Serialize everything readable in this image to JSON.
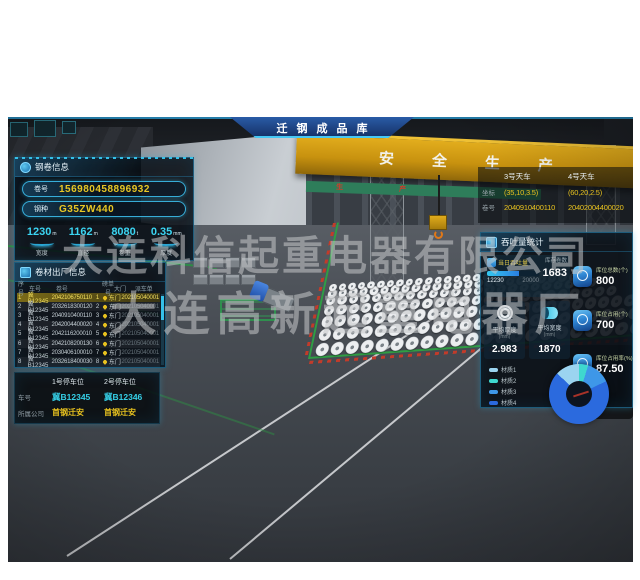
{
  "window": {
    "title": "迁钢成品库"
  },
  "scene": {
    "girder_text": "安全生产",
    "girder_text2": "生产"
  },
  "watermark": {
    "line1": "大连科信起重电器有限公司",
    "line2": "大连高新起重电器厂"
  },
  "coil_info": {
    "title": "钢卷信息",
    "fields": [
      {
        "label": "卷号",
        "value": "156980458896932"
      },
      {
        "label": "钢种",
        "value": "G35ZW440"
      }
    ],
    "stats": [
      {
        "value": "1230",
        "unit": "m",
        "label": "宽度"
      },
      {
        "value": "1162",
        "unit": "m",
        "label": "直径"
      },
      {
        "value": "8080",
        "unit": "t",
        "label": "卷重"
      },
      {
        "value": "0.35",
        "unit": "mm",
        "label": "厚度"
      }
    ]
  },
  "shipment": {
    "title": "卷材出厂信息",
    "columns": [
      "序号",
      "车号",
      "卷号",
      "磅单号",
      "大门",
      "派车单"
    ],
    "rows": [
      [
        "1",
        "冀B12345",
        "2042106750110",
        "1",
        "东门",
        "202105040001"
      ],
      [
        "2",
        "冀B12345",
        "2032618300120",
        "2",
        "东门",
        "202105040001"
      ],
      [
        "3",
        "冀B12345",
        "2040910400110",
        "3",
        "东门",
        "202105040001"
      ],
      [
        "4",
        "冀B12345",
        "2042004400020",
        "4",
        "东门",
        "202105040001"
      ],
      [
        "5",
        "冀B12345",
        "2042116200010",
        "5",
        "东门",
        "202105040001"
      ],
      [
        "6",
        "冀B12345",
        "2042108200130",
        "6",
        "东门",
        "202105040001"
      ],
      [
        "7",
        "冀B12345",
        "2030406100010",
        "7",
        "东门",
        "202105040001"
      ],
      [
        "8",
        "冀B12345",
        "2032618400030",
        "8",
        "东门",
        "202105040001"
      ]
    ],
    "highlighted_row": 0
  },
  "parking": {
    "plate_label": "车号",
    "company_label": "所属公司",
    "spots": [
      {
        "title": "1号停车位",
        "plate": "冀B12345",
        "company": "首钢迁安"
      },
      {
        "title": "2号停车位",
        "plate": "冀B12346",
        "company": "首钢迁安"
      }
    ]
  },
  "cranes": {
    "coord_label": "坐标",
    "coil_label": "卷号",
    "items": [
      {
        "name": "3号天车",
        "coord": "(35,10,3.5)",
        "coil": "2040910400110"
      },
      {
        "name": "4号天车",
        "coord": "(60,20,2.5)",
        "coil": "20402004400020"
      }
    ]
  },
  "stats": {
    "title": "吞吐量统计",
    "throughput": {
      "label": "当日吞吐量",
      "current": "12230",
      "max": "20000",
      "percent": 61
    },
    "inventory": {
      "label": "库存卷数",
      "value": "1683"
    },
    "tiles": [
      {
        "label": "平均厚度",
        "unit": "(mm)",
        "value": "2.983"
      },
      {
        "label": "平均宽度",
        "unit": "(mm)",
        "value": "1870"
      }
    ],
    "kpis": [
      {
        "label": "库位总数(个)",
        "value": "800"
      },
      {
        "label": "库位占用(个)",
        "value": "700"
      },
      {
        "label": "库位占用率(%)",
        "value": "87.50"
      }
    ]
  },
  "chart_data": {
    "type": "pie",
    "labels": [
      "材质1",
      "材质2",
      "材质3",
      "材质4"
    ],
    "values": [
      13,
      5,
      13,
      69
    ],
    "colors": [
      "#9bd4f0",
      "#3fd8cf",
      "#3e97e8",
      "#2b6ade"
    ],
    "legend_position": "left"
  },
  "colors": {
    "accent": "#2aa7d4",
    "value_yellow": "#e8c21f",
    "value_cyan": "#38d2f0"
  }
}
